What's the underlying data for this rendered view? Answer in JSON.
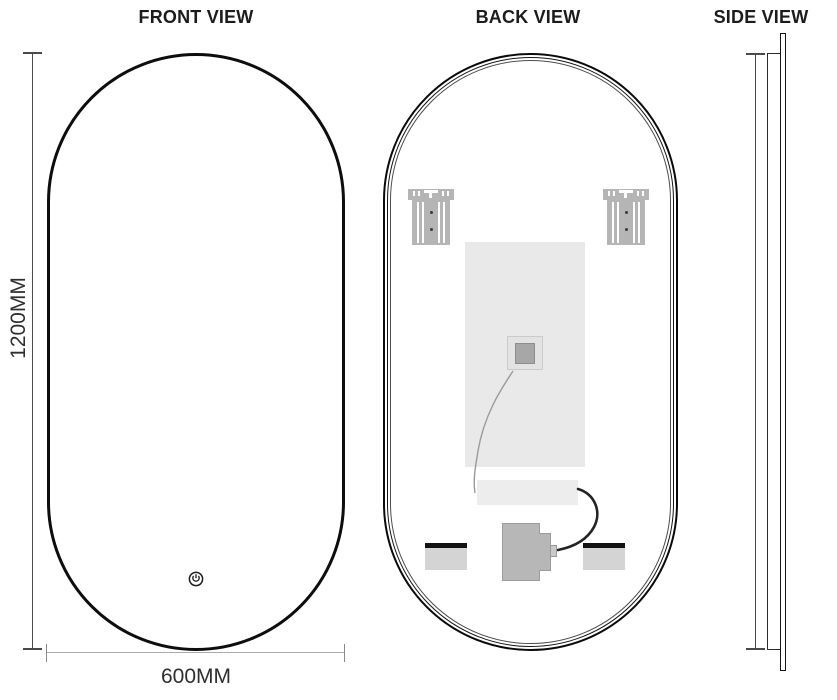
{
  "views": {
    "front": {
      "title": "FRONT VIEW"
    },
    "back": {
      "title": "BACK VIEW"
    },
    "side": {
      "title": "SIDE VIEW"
    }
  },
  "dimensions": {
    "height": "1200MM",
    "width": "600MM"
  },
  "icons": {
    "touch_switch": "power-icon"
  },
  "colors": {
    "outline": "#0d0d0d",
    "dim-line-dark": "#4a4a4a",
    "dim-line-mid": "#8a8a8a",
    "dim-line-light": "#ababab",
    "dim-text": "#2f2f2f",
    "bracket": "#b5b5b5",
    "bracket-dot": "#3a3a3a",
    "pad": "#e9e9e9",
    "strip": "#ededed",
    "junction-outer": "#e3e3e3",
    "junction-inner": "#a7a7a7",
    "driver": "#b7b7b7",
    "bar-body": "#d4d4d4",
    "bar-top": "#111111",
    "wire-gray": "#9a9a9a",
    "wire-black": "#232323"
  }
}
